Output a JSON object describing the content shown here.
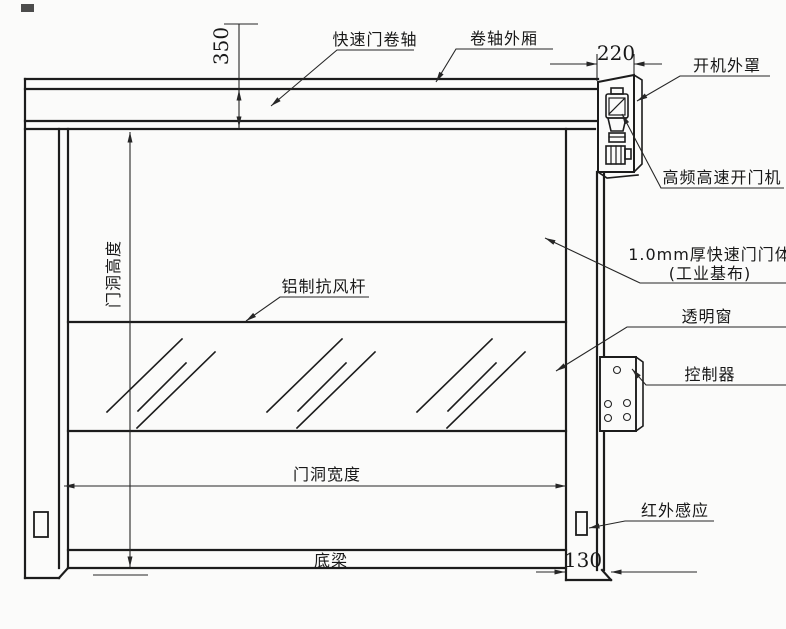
{
  "labels": {
    "roller": "快速门卷轴",
    "roller_box": "卷轴外厢",
    "machine_cover": "开机外罩",
    "opener": "高频高速开门机",
    "door_body_line1": "1.0mm厚快速门门体",
    "door_body_line2": "(工业基布)",
    "wind_bar": "铝制抗风杆",
    "window": "透明窗",
    "controller": "控制器",
    "ir_sensor": "红外感应",
    "door_height": "门洞高度",
    "door_width": "门洞宽度",
    "bottom_beam": "底梁"
  },
  "dimensions": {
    "header_height": "350",
    "cover_width": "220",
    "bottom_depth": "130"
  },
  "colors": {
    "background": "#fbfbfa",
    "line": "#1c1c1c"
  }
}
